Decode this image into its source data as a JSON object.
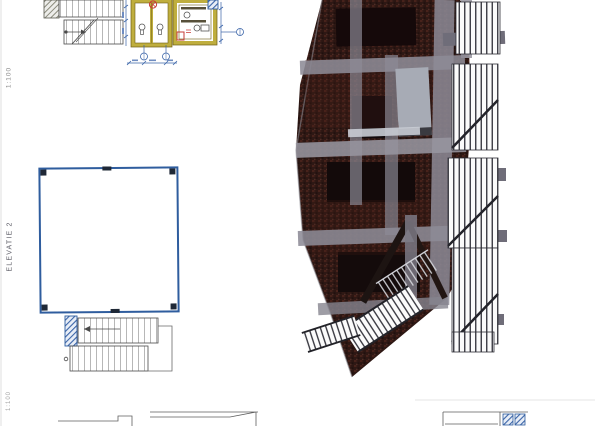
{
  "annotations": {
    "scale_top": "1:100",
    "elevation_label": "ELEVATIE 2",
    "scale_bottom": "1:100"
  },
  "colors": {
    "paper_white": "#ffffff",
    "dimension_blue": "#3a64a8",
    "plan_outline_blue": "#2f5d9e",
    "wall_olive_yellow": "#bfae3e",
    "fixture_red": "#c63b36",
    "building_brick_dark": "#2e1814",
    "concrete_gray": "#8d8b96",
    "line_dark": "#444444"
  },
  "figures": {
    "stair_plan_top": "staircase-plan-fragment",
    "sanitary_plan": "sanitary-rooms-plan-with-fixtures",
    "roof_plan": "empty-rectangular-plan-outline",
    "stair_plan_bottom": "external-staircase-plan",
    "rendering": "dark-3d-building-perspective-with-fire-escape-stairs",
    "bottom_fragments": "cropped-drawing-fragments-at-sheet-edge"
  }
}
